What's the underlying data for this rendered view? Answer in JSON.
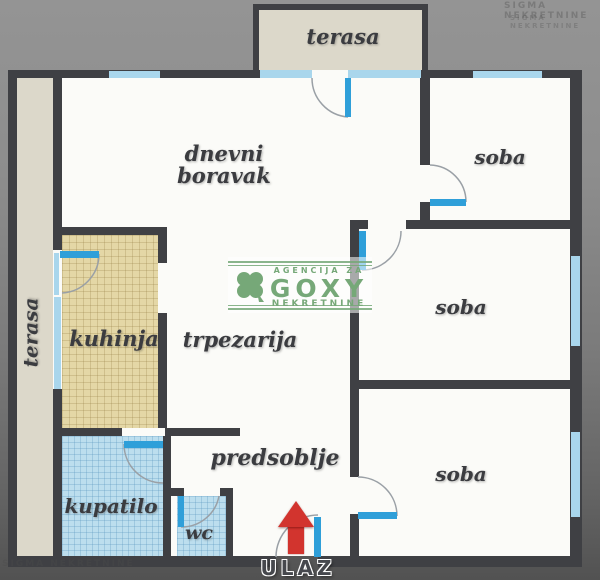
{
  "labels": {
    "terasa_top": "terasa",
    "terasa_left": "terasa",
    "dnevni_boravak": "dnevni boravak",
    "soba_top": "soba",
    "soba_middle": "soba",
    "soba_bottom": "soba",
    "kuhinja": "kuhinja",
    "trpezarija": "trpezarija",
    "predsoblje": "predsoblje",
    "kupatilo": "kupatilo",
    "wc": "wc",
    "ulaz": "ULAZ"
  },
  "watermark": {
    "top_line": "AGENCIJA ZA",
    "name": "GOXY",
    "bottom_line": "NEKRETNINE"
  },
  "corner_watermarks": {
    "top_right_line1": "SIGMA NEKRETNINE",
    "top_right_line2": "SIGMA NEKRETNINE",
    "bottom_left": "SIGMA NEKRETNINE"
  },
  "colors": {
    "wall": "#3f4044",
    "window": "#a9d6ec",
    "door": "#2f9fd9",
    "room": "#fbfbf8",
    "terrace": "#dcd8ca",
    "kitchen": "#e4d7a6",
    "bath": "#bcdeee",
    "arrow": "#d2342e",
    "brand": "#76a878"
  }
}
